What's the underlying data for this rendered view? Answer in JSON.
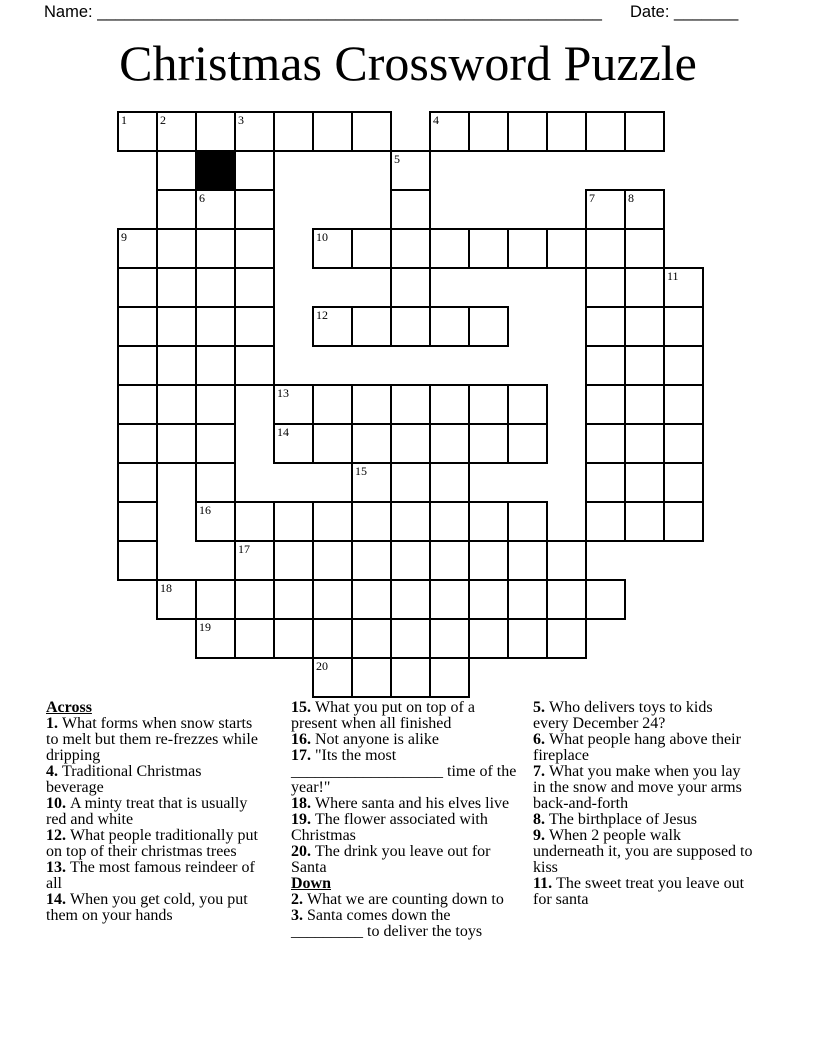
{
  "header": {
    "name_label": "Name:",
    "name_blank": "_______________________________________________________",
    "date_label": "Date:",
    "date_blank": "_______"
  },
  "title": "Christmas Crossword Puzzle",
  "grid": {
    "cols": 15,
    "rows_count": 15,
    "cell_px": 39,
    "rows": [
      {
        "r": 0,
        "runs": [
          [
            0,
            6
          ],
          [
            8,
            13
          ]
        ]
      },
      {
        "r": 1,
        "runs": [
          [
            1,
            3
          ],
          [
            7,
            7
          ]
        ]
      },
      {
        "r": 2,
        "runs": [
          [
            1,
            3
          ],
          [
            7,
            7
          ],
          [
            12,
            13
          ]
        ]
      },
      {
        "r": 3,
        "runs": [
          [
            0,
            3
          ],
          [
            5,
            13
          ]
        ]
      },
      {
        "r": 4,
        "runs": [
          [
            0,
            3
          ],
          [
            7,
            7
          ],
          [
            12,
            14
          ]
        ]
      },
      {
        "r": 5,
        "runs": [
          [
            0,
            3
          ],
          [
            5,
            9
          ],
          [
            12,
            14
          ]
        ]
      },
      {
        "r": 6,
        "runs": [
          [
            0,
            3
          ],
          [
            12,
            14
          ]
        ]
      },
      {
        "r": 7,
        "runs": [
          [
            0,
            2
          ],
          [
            4,
            10
          ],
          [
            12,
            14
          ]
        ]
      },
      {
        "r": 8,
        "runs": [
          [
            0,
            2
          ],
          [
            4,
            10
          ],
          [
            12,
            14
          ]
        ]
      },
      {
        "r": 9,
        "runs": [
          [
            0,
            0
          ],
          [
            2,
            2
          ],
          [
            6,
            8
          ],
          [
            12,
            14
          ]
        ]
      },
      {
        "r": 10,
        "runs": [
          [
            0,
            0
          ],
          [
            2,
            10
          ],
          [
            12,
            14
          ]
        ]
      },
      {
        "r": 11,
        "runs": [
          [
            0,
            0
          ],
          [
            3,
            11
          ]
        ]
      },
      {
        "r": 12,
        "runs": [
          [
            1,
            12
          ]
        ]
      },
      {
        "r": 13,
        "runs": [
          [
            2,
            11
          ]
        ]
      },
      {
        "r": 14,
        "runs": [
          [
            5,
            8
          ]
        ]
      }
    ],
    "black_cells": [
      [
        1,
        2
      ]
    ],
    "numbers": [
      [
        "1",
        0,
        0
      ],
      [
        "2",
        0,
        1
      ],
      [
        "3",
        0,
        3
      ],
      [
        "4",
        0,
        8
      ],
      [
        "5",
        1,
        7
      ],
      [
        "6",
        2,
        2
      ],
      [
        "7",
        2,
        12
      ],
      [
        "8",
        2,
        13
      ],
      [
        "9",
        3,
        0
      ],
      [
        "10",
        3,
        5
      ],
      [
        "11",
        4,
        14
      ],
      [
        "12",
        5,
        5
      ],
      [
        "13",
        7,
        4
      ],
      [
        "14",
        8,
        4
      ],
      [
        "15",
        9,
        6
      ],
      [
        "16",
        10,
        2
      ],
      [
        "17",
        11,
        3
      ],
      [
        "18",
        12,
        1
      ],
      [
        "19",
        13,
        2
      ],
      [
        "20",
        14,
        5
      ]
    ]
  },
  "clues": {
    "columns": [
      {
        "items": [
          {
            "h": "Across"
          },
          {
            "n": "1.",
            "t": "What forms when snow starts\nto melt but them re-frezzes while\ndripping"
          },
          {
            "n": "4.",
            "t": "Traditional Christmas\nbeverage"
          },
          {
            "n": "10.",
            "t": "A minty treat that is usually\nred and white"
          },
          {
            "n": "12.",
            "t": "What people traditionally put\non top of their christmas trees"
          },
          {
            "n": "13.",
            "t": "The most famous reindeer of\nall"
          },
          {
            "n": "14.",
            "t": "When you get cold, you put\nthem on your hands"
          }
        ]
      },
      {
        "items": [
          {
            "n": "15.",
            "t": "What you put on top of a\npresent when all finished"
          },
          {
            "n": "16.",
            "t": "Not anyone is alike"
          },
          {
            "n": "17.",
            "t": "\"Its the most\n___________________ time of the\nyear!\""
          },
          {
            "n": "18.",
            "t": "Where santa and his elves live"
          },
          {
            "n": "19.",
            "t": "The flower associated with\nChristmas"
          },
          {
            "n": "20.",
            "t": "The drink you leave out for\nSanta"
          },
          {
            "h": "Down"
          },
          {
            "n": "2.",
            "t": "What we are counting down to"
          },
          {
            "n": "3.",
            "t": "Santa comes down the\n_________ to deliver the toys"
          }
        ]
      },
      {
        "items": [
          {
            "n": "5.",
            "t": "Who delivers toys to kids\nevery December 24?"
          },
          {
            "n": "6.",
            "t": "What people hang above their\nfireplace"
          },
          {
            "n": "7.",
            "t": "What you make when you lay\nin the snow and move your arms\nback-and-forth"
          },
          {
            "n": "8.",
            "t": "The birthplace of Jesus"
          },
          {
            "n": "9.",
            "t": "When 2 people walk\nunderneath it, you are supposed to\nkiss"
          },
          {
            "n": "11.",
            "t": "The sweet treat you leave out\nfor santa"
          }
        ]
      }
    ]
  }
}
